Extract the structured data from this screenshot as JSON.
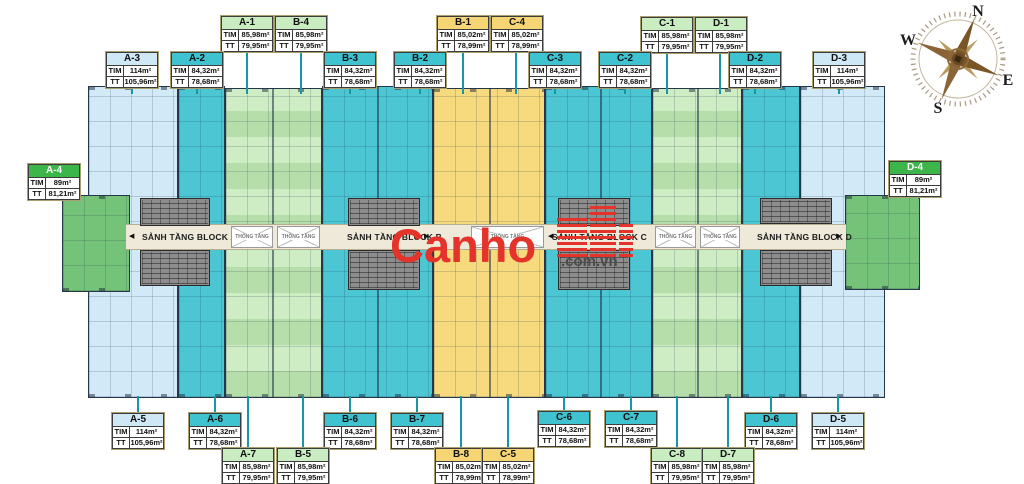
{
  "labels": {
    "tim": "TIM",
    "tt": "TT"
  },
  "units": {
    "a1": {
      "name": "A-1",
      "tim": "85,98m²",
      "tt": "79,95m²"
    },
    "a2": {
      "name": "A-2",
      "tim": "84,32m²",
      "tt": "78,68m²"
    },
    "a3": {
      "name": "A-3",
      "tim": "114m²",
      "tt": "105,96m²"
    },
    "a4": {
      "name": "A-4",
      "tim": "89m²",
      "tt": "81,21m²"
    },
    "a5": {
      "name": "A-5",
      "tim": "114m²",
      "tt": "105,96m²"
    },
    "a6": {
      "name": "A-6",
      "tim": "84,32m²",
      "tt": "78,68m²"
    },
    "a7": {
      "name": "A-7",
      "tim": "85,98m²",
      "tt": "79,95m²"
    },
    "b1": {
      "name": "B-1",
      "tim": "85,02m²",
      "tt": "78,99m²"
    },
    "b2": {
      "name": "B-2",
      "tim": "84,32m²",
      "tt": "78,68m²"
    },
    "b3": {
      "name": "B-3",
      "tim": "84,32m²",
      "tt": "78,68m²"
    },
    "b4": {
      "name": "B-4",
      "tim": "85,98m²",
      "tt": "79,95m²"
    },
    "b5": {
      "name": "B-5",
      "tim": "85,98m²",
      "tt": "79,95m²"
    },
    "b6": {
      "name": "B-6",
      "tim": "84,32m²",
      "tt": "78,68m²"
    },
    "b7": {
      "name": "B-7",
      "tim": "84,32m²",
      "tt": "78,68m²"
    },
    "b8": {
      "name": "B-8",
      "tim": "85,02m²",
      "tt": "78,99m²"
    },
    "c1": {
      "name": "C-1",
      "tim": "85,98m²",
      "tt": "79,95m²"
    },
    "c2": {
      "name": "C-2",
      "tim": "84,32m²",
      "tt": "78,68m²"
    },
    "c3": {
      "name": "C-3",
      "tim": "84,32m²",
      "tt": "78,68m²"
    },
    "c4": {
      "name": "C-4",
      "tim": "85,02m²",
      "tt": "78,99m²"
    },
    "c5": {
      "name": "C-5",
      "tim": "85,02m²",
      "tt": "78,99m²"
    },
    "c6": {
      "name": "C-6",
      "tim": "84,32m²",
      "tt": "78,68m²"
    },
    "c7": {
      "name": "C-7",
      "tim": "84,32m²",
      "tt": "78,68m²"
    },
    "c8": {
      "name": "C-8",
      "tim": "85,98m²",
      "tt": "79,95m²"
    },
    "d1": {
      "name": "D-1",
      "tim": "85,98m²",
      "tt": "79,95m²"
    },
    "d2": {
      "name": "D-2",
      "tim": "84,32m²",
      "tt": "78,68m²"
    },
    "d3": {
      "name": "D-3",
      "tim": "114m²",
      "tt": "105,96m²"
    },
    "d4": {
      "name": "D-4",
      "tim": "89m²",
      "tt": "81,21m²"
    },
    "d5": {
      "name": "D-5",
      "tim": "114m²",
      "tt": "105,96m²"
    },
    "d6": {
      "name": "D-6",
      "tim": "84,32m²",
      "tt": "78,68m²"
    },
    "d7": {
      "name": "D-7",
      "tim": "85,98m²",
      "tt": "79,95m²"
    }
  },
  "corridors": {
    "a": {
      "label": "SẢNH TẦNG BLOCK A"
    },
    "b": {
      "label": "SẢNH TẦNG BLOCK B"
    },
    "c": {
      "label": "SẢNH TẦNG BLOCK C"
    },
    "d": {
      "label": "SẢNH TẦNG BLOCK D"
    }
  },
  "voids": {
    "label": "THÔNG TẦNG"
  },
  "compass": {
    "n": "N",
    "e": "E",
    "s": "S",
    "w": "W"
  },
  "watermark": {
    "brand": "Canho",
    "suffix": ".com.vn"
  },
  "colors": {
    "teal": "#4cc6d2",
    "light_blue": "#d2eaf7",
    "pale_green": "#cfedc4",
    "yellow": "#f6da7d",
    "green": "#3cb54a",
    "core_gray": "#8d8d8d",
    "corridor_cream": "#efe9d9",
    "connector": "#1896a6",
    "watermark_red": "#e3332a"
  }
}
